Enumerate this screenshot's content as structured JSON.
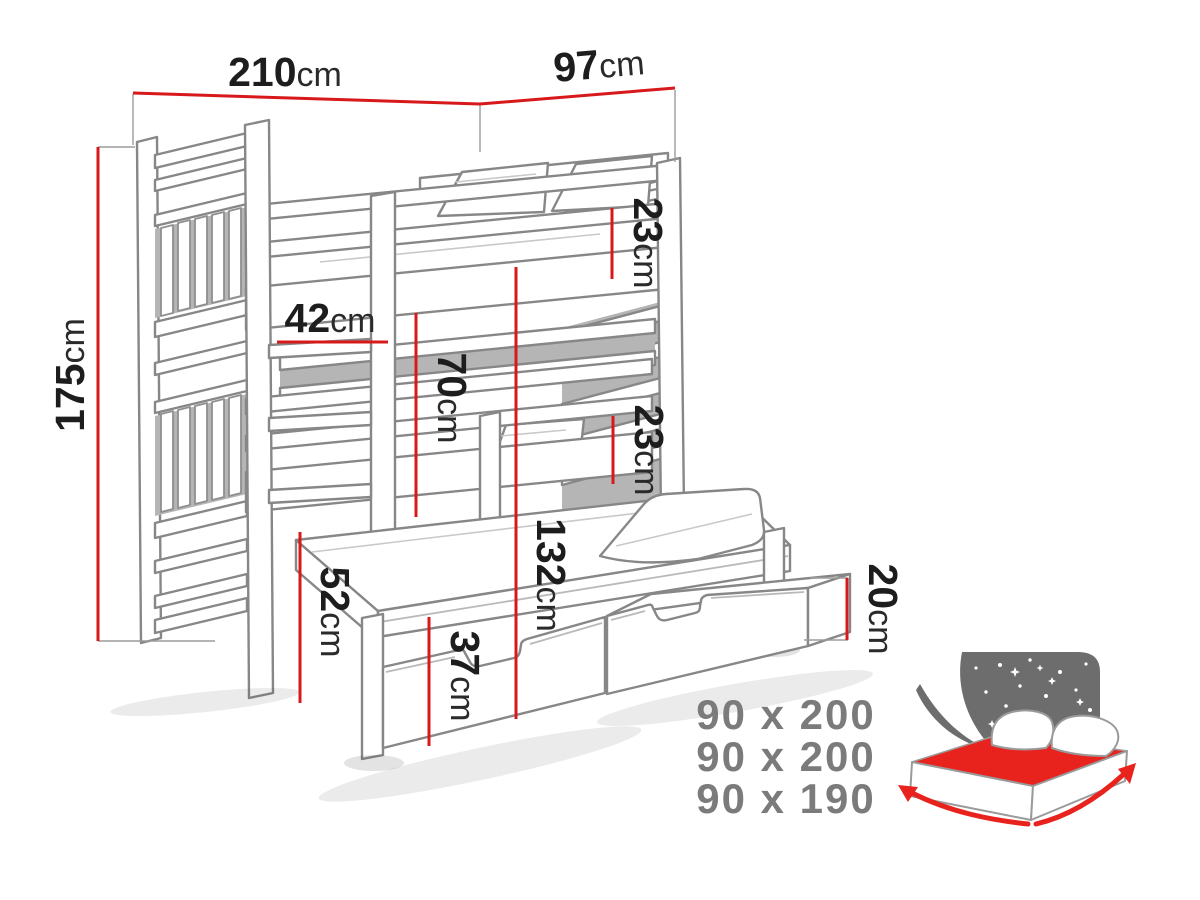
{
  "title": "Triple bunk bed with trundle and drawers - dimension diagram",
  "dimensions": {
    "width": {
      "value": "210",
      "unit": "cm"
    },
    "depth": {
      "value": "97",
      "unit": "cm"
    },
    "height": {
      "value": "175",
      "unit": "cm"
    },
    "upper_guard": {
      "value": "23",
      "unit": "cm"
    },
    "ladder_rung": {
      "value": "42",
      "unit": "cm"
    },
    "clearance": {
      "value": "70",
      "unit": "cm"
    },
    "middle_guard": {
      "value": "23",
      "unit": "cm"
    },
    "middle_height": {
      "value": "132",
      "unit": "cm"
    },
    "trundle_height": {
      "value": "52",
      "unit": "cm"
    },
    "drawer_front": {
      "value": "37",
      "unit": "cm"
    },
    "drawer_side": {
      "value": "20",
      "unit": "cm"
    }
  },
  "bed_sizes": [
    "90 x 200",
    "90 x 200",
    "90 x 190"
  ],
  "logo": {
    "name": "starry-night-bed-logo"
  },
  "colors": {
    "dimension_red": "#d7191c",
    "outline_gray": "#878787",
    "label_dark": "#1d1d1d",
    "size_text_gray": "#7b7b7b",
    "logo_panel_gray": "#6d6d6d",
    "logo_red": "#e8231e"
  }
}
